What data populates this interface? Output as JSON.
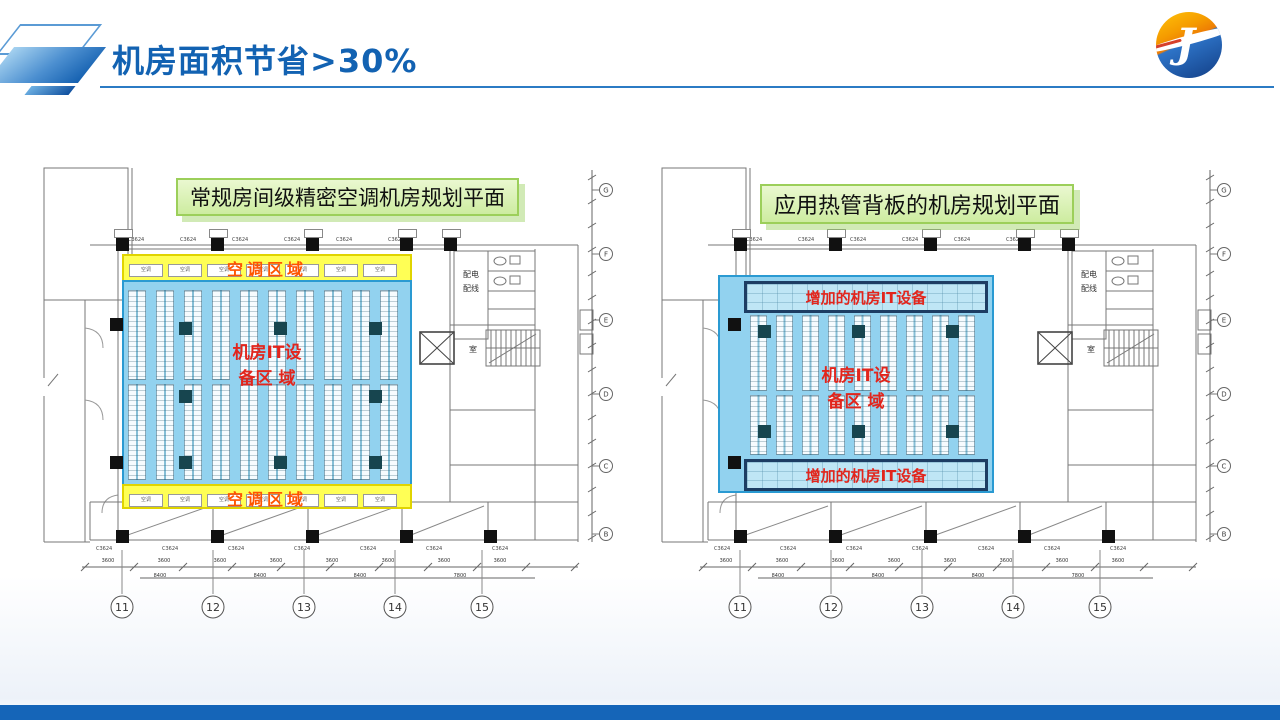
{
  "slide": {
    "title": "机房面积节省>30%",
    "title_color": "#1262b2",
    "underline_color": "#2b7bc4",
    "footer_bar_color": "#1565b8",
    "logo_letter": "J"
  },
  "diagrams": [
    {
      "type": "conventional",
      "caption": "常规房间级精密空调机房规划平面",
      "it_zone_line1": "机房IT设",
      "it_zone_line2": "备区 域",
      "ac_zone_label": "空调区域",
      "ac_unit_label": "空调",
      "ac_unit_count": 7,
      "beam_label": "C3624",
      "grid_axis_numbers": [
        "11",
        "12",
        "13",
        "14",
        "15"
      ],
      "vertical_axis_letters": [
        "G",
        "F",
        "E",
        "D",
        "C",
        "B"
      ],
      "dim_row1": [
        "3600",
        "3600",
        "3600",
        "3600",
        "3600",
        "3600",
        "3600",
        "3600"
      ],
      "dim_row2": [
        "8400",
        "8400",
        "8400",
        "7800"
      ],
      "annex": {
        "power_line1": "配电",
        "power_line2": "配线",
        "room_label": "室"
      },
      "colors": {
        "zone_fill": "#92d2ef",
        "zone_border": "#2a9ad2",
        "ac_fill": "#ffff55",
        "ac_border": "#e0d400",
        "ac_text": "#ff5400",
        "label_red": "#e2251c",
        "caption_border": "#9ccf5a",
        "column_dark": "#17454f"
      }
    },
    {
      "type": "heat-pipe",
      "caption": "应用热管背板的机房规划平面",
      "it_zone_line1": "机房IT设",
      "it_zone_line2": "备区 域",
      "added_it_label": "增加的机房IT设备",
      "beam_label": "C3624",
      "grid_axis_numbers": [
        "11",
        "12",
        "13",
        "14",
        "15"
      ],
      "vertical_axis_letters": [
        "G",
        "F",
        "E",
        "D",
        "C",
        "B"
      ],
      "dim_row1": [
        "3600",
        "3600",
        "3600",
        "3600",
        "3600",
        "3600",
        "3600",
        "3600"
      ],
      "dim_row2": [
        "8400",
        "8400",
        "8400",
        "7800"
      ],
      "annex": {
        "power_line1": "配电",
        "power_line2": "配线",
        "room_label": "室"
      },
      "colors": {
        "zone_fill": "#92d2ef",
        "zone_border": "#2a9ad2",
        "ac_fill": "#ffff55",
        "ac_border": "#e0d400",
        "ac_text": "#ff5400",
        "label_red": "#e2251c",
        "caption_border": "#9ccf5a",
        "column_dark": "#17454f"
      }
    }
  ]
}
